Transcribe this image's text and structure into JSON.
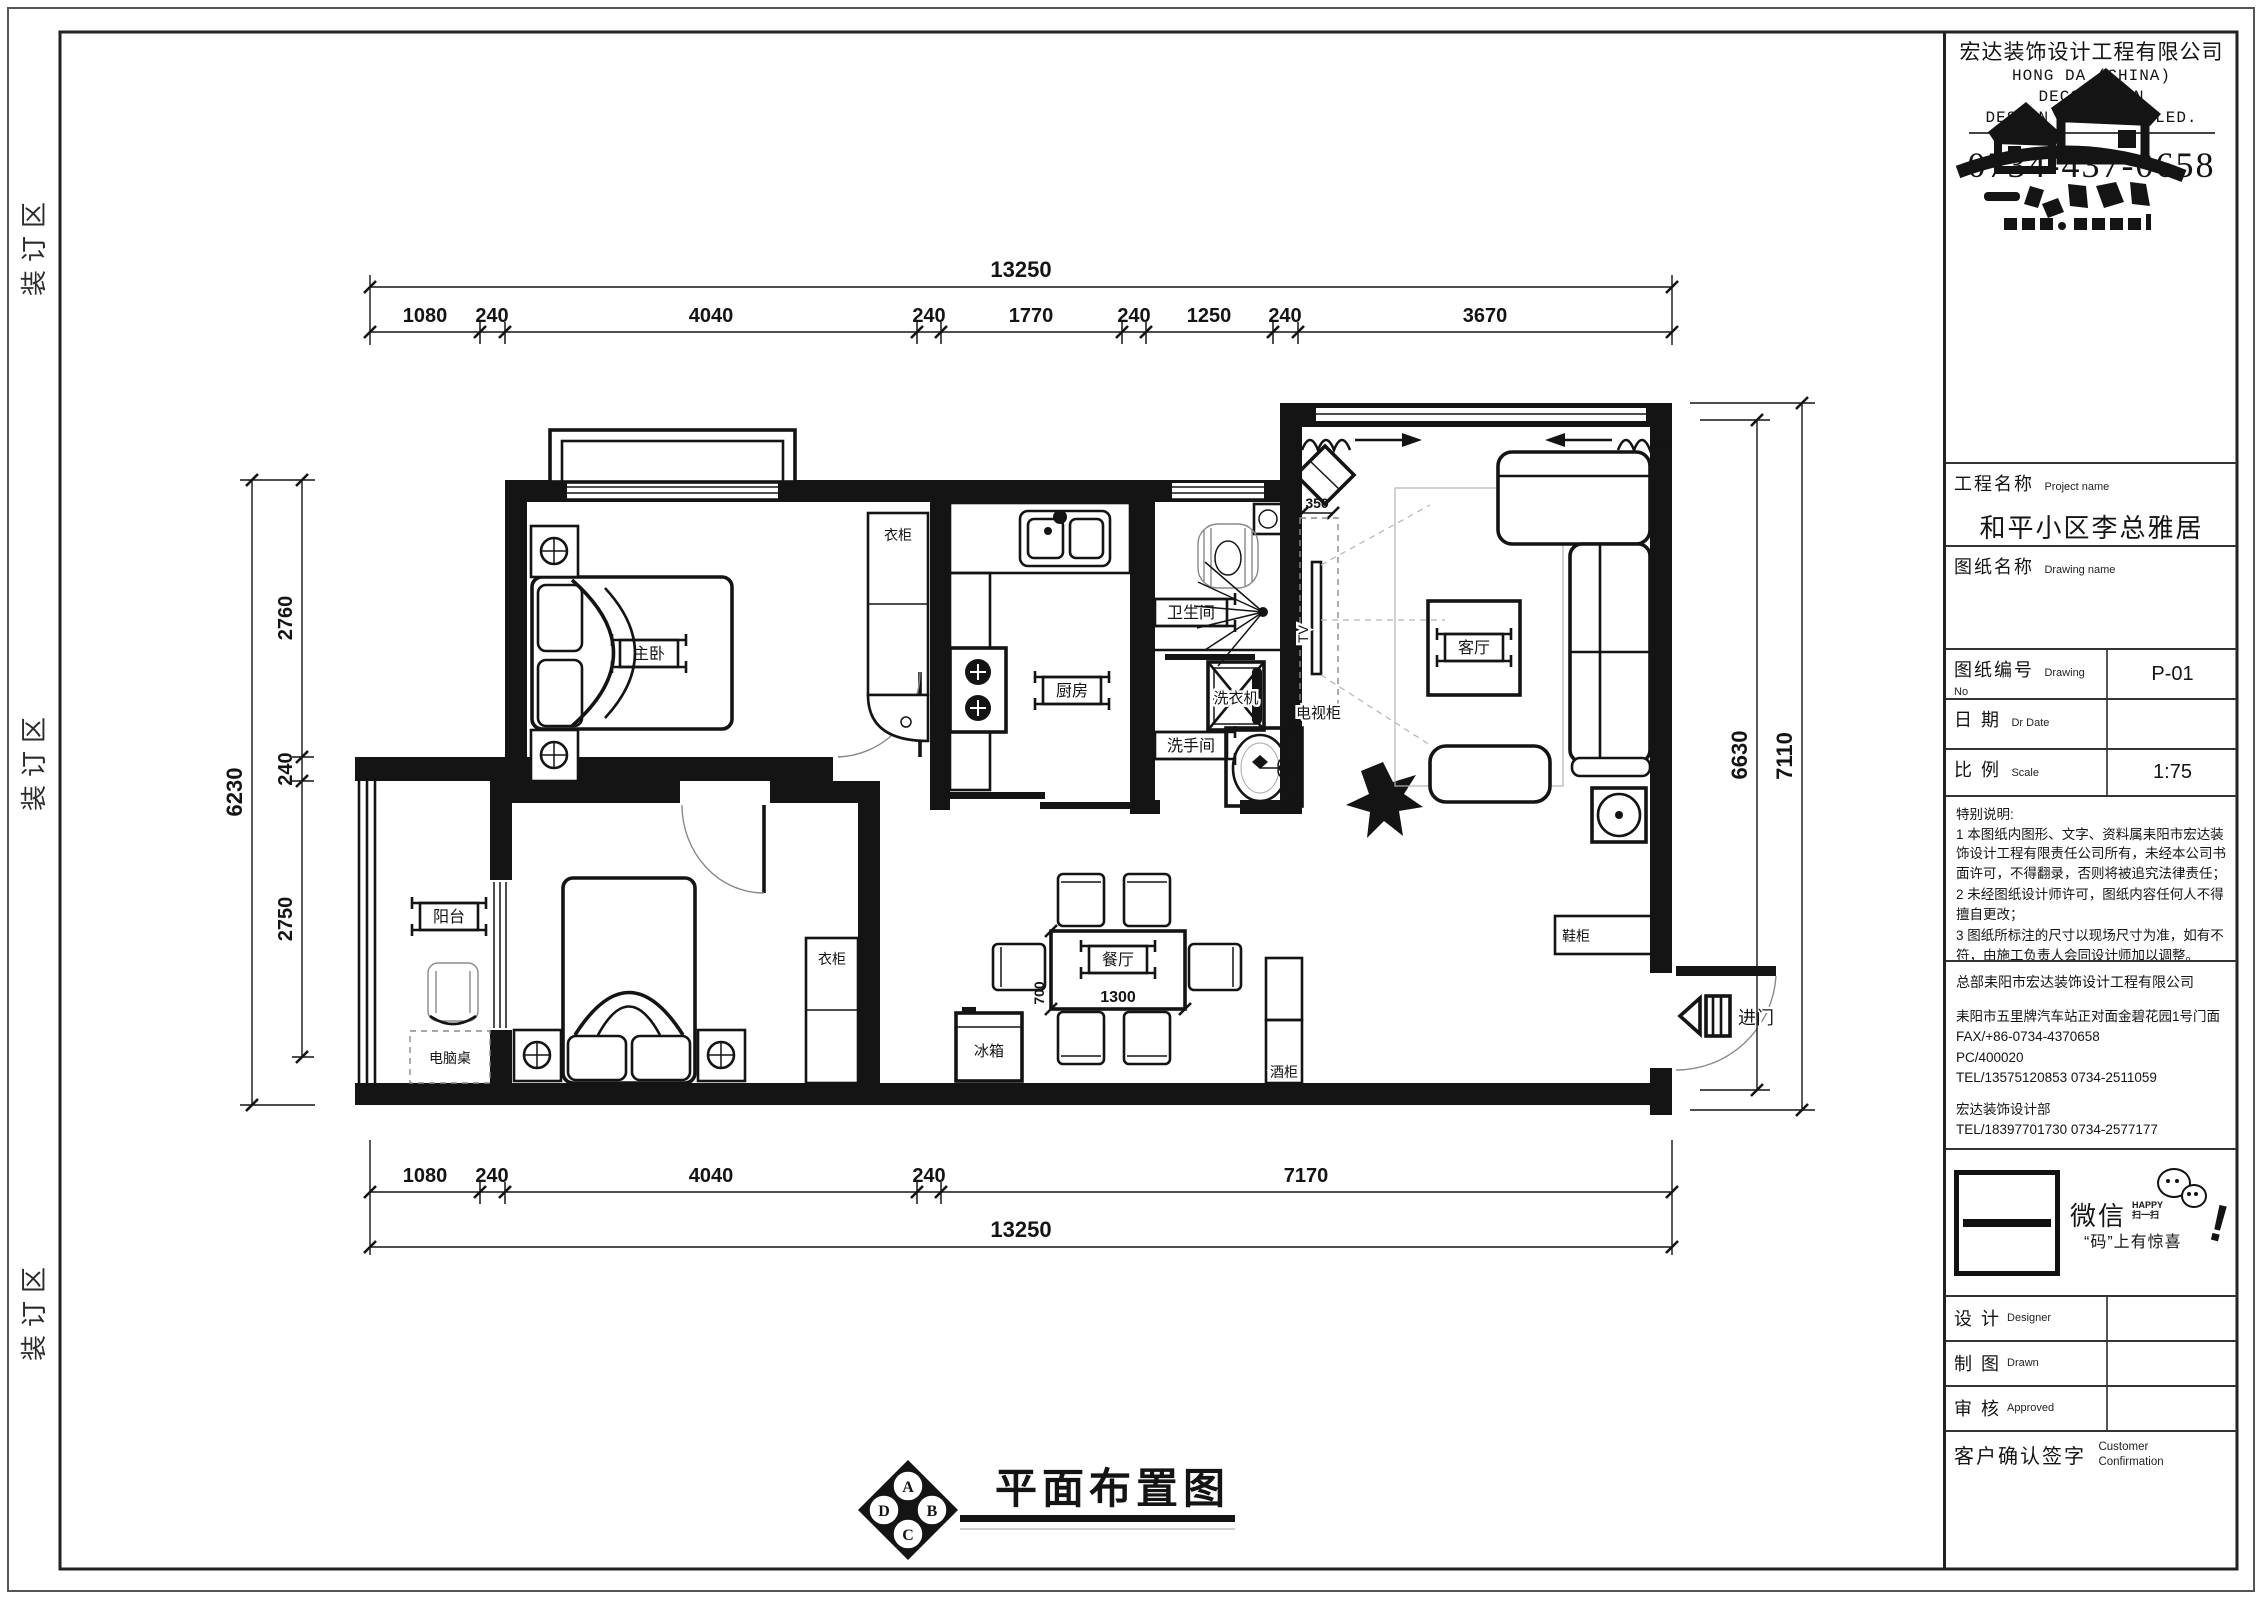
{
  "sheet": {
    "binding_label": "装订区",
    "plan_title": "平面布置图",
    "compass": {
      "top": "A",
      "right": "B",
      "bottom": "C",
      "left": "D"
    }
  },
  "title_block": {
    "company_cn": "宏达装饰设计工程有限公司",
    "company_en_line1": "HONG DA (CHINA)",
    "company_en_line2": "DECORATION",
    "company_en_line3": "DESIGN PROJECTS LED.",
    "phone": "0734-437-0658",
    "project_label_cn": "工程名称",
    "project_label_en": "Project name",
    "project_value": "和平小区李总雅居",
    "drawing_name_label_cn": "图纸名称",
    "drawing_name_label_en": "Drawing name",
    "drawing_no_label_cn": "图纸编号",
    "drawing_no_label_en": "Drawing No",
    "drawing_no_value": "P-01",
    "date_label_cn": "日  期",
    "date_label_en": "Dr  Date",
    "scale_label_cn": "比  例",
    "scale_label_en": "Scale",
    "scale_value": "1:75",
    "notes_title": "特别说明:",
    "notes": [
      "1 本图纸内图形、文字、资料属耒阳市宏达装饰设计工程有限责任公司所有，未经本公司书面许可，不得翻录，否则将被追究法律责任；",
      "2 未经图纸设计师许可，图纸内容任何人不得擅自更改；",
      "3 图纸所标注的尺寸以现场尺寸为准，如有不符，由施工负责人会同设计师加以调整。"
    ],
    "hq_line": "总部耒阳市宏达装饰设计工程有限公司",
    "address_line": "耒阳市五里牌汽车站正对面金碧花园1号门面",
    "fax_line": "FAX/+86-0734-4370658",
    "pc_line": "PC/400020",
    "tel_line": "TEL/13575120853      0734-2511059",
    "dept_line": "宏达装饰设计部",
    "dept_tel_line": "TEL/18397701730      0734-2577177",
    "wechat": {
      "name": "微信",
      "happy": "HAPPY",
      "scan": "扫一扫",
      "slogan": "“码”上有惊喜",
      "bang": "!"
    },
    "sign_rows": [
      {
        "cn": "设  计",
        "en": "Designer"
      },
      {
        "cn": "制  图",
        "en": "Drawn"
      },
      {
        "cn": "审  核",
        "en": "Approved"
      }
    ],
    "customer_label_cn": "客户确认签字",
    "customer_label_en1": "Customer",
    "customer_label_en2": "Confirmation"
  },
  "plan": {
    "labels": {
      "master": "主卧",
      "kitchen": "厨房",
      "bathroom": "卫生间",
      "washroom": "洗手间",
      "living": "客厅",
      "dining": "餐厅",
      "balcony": "阳台",
      "wardrobe_master": "衣柜",
      "wardrobe_bedroom2": "衣柜",
      "washer": "洗衣机",
      "tv_cabinet": "电视柜",
      "tv": "TV",
      "fridge": "冰箱",
      "wine_cabinet": "酒柜",
      "shoe_cabinet": "鞋柜",
      "entry": "进门",
      "computer_desk": "电脑桌"
    },
    "dims": {
      "top_total": "13250",
      "top_segments": [
        "1080",
        "240",
        "4040",
        "240",
        "1770",
        "240",
        "1250",
        "240",
        "3670"
      ],
      "bottom_segments": [
        "1080",
        "240",
        "4040",
        "240",
        "7170"
      ],
      "bottom_total": "13250",
      "left_total": "6230",
      "left_segments": [
        "2760",
        "240",
        "2750"
      ],
      "right_inner": "6630",
      "right_outer": "7110",
      "tv_width": "350",
      "table_depth": "700",
      "table_width": "1300"
    }
  }
}
